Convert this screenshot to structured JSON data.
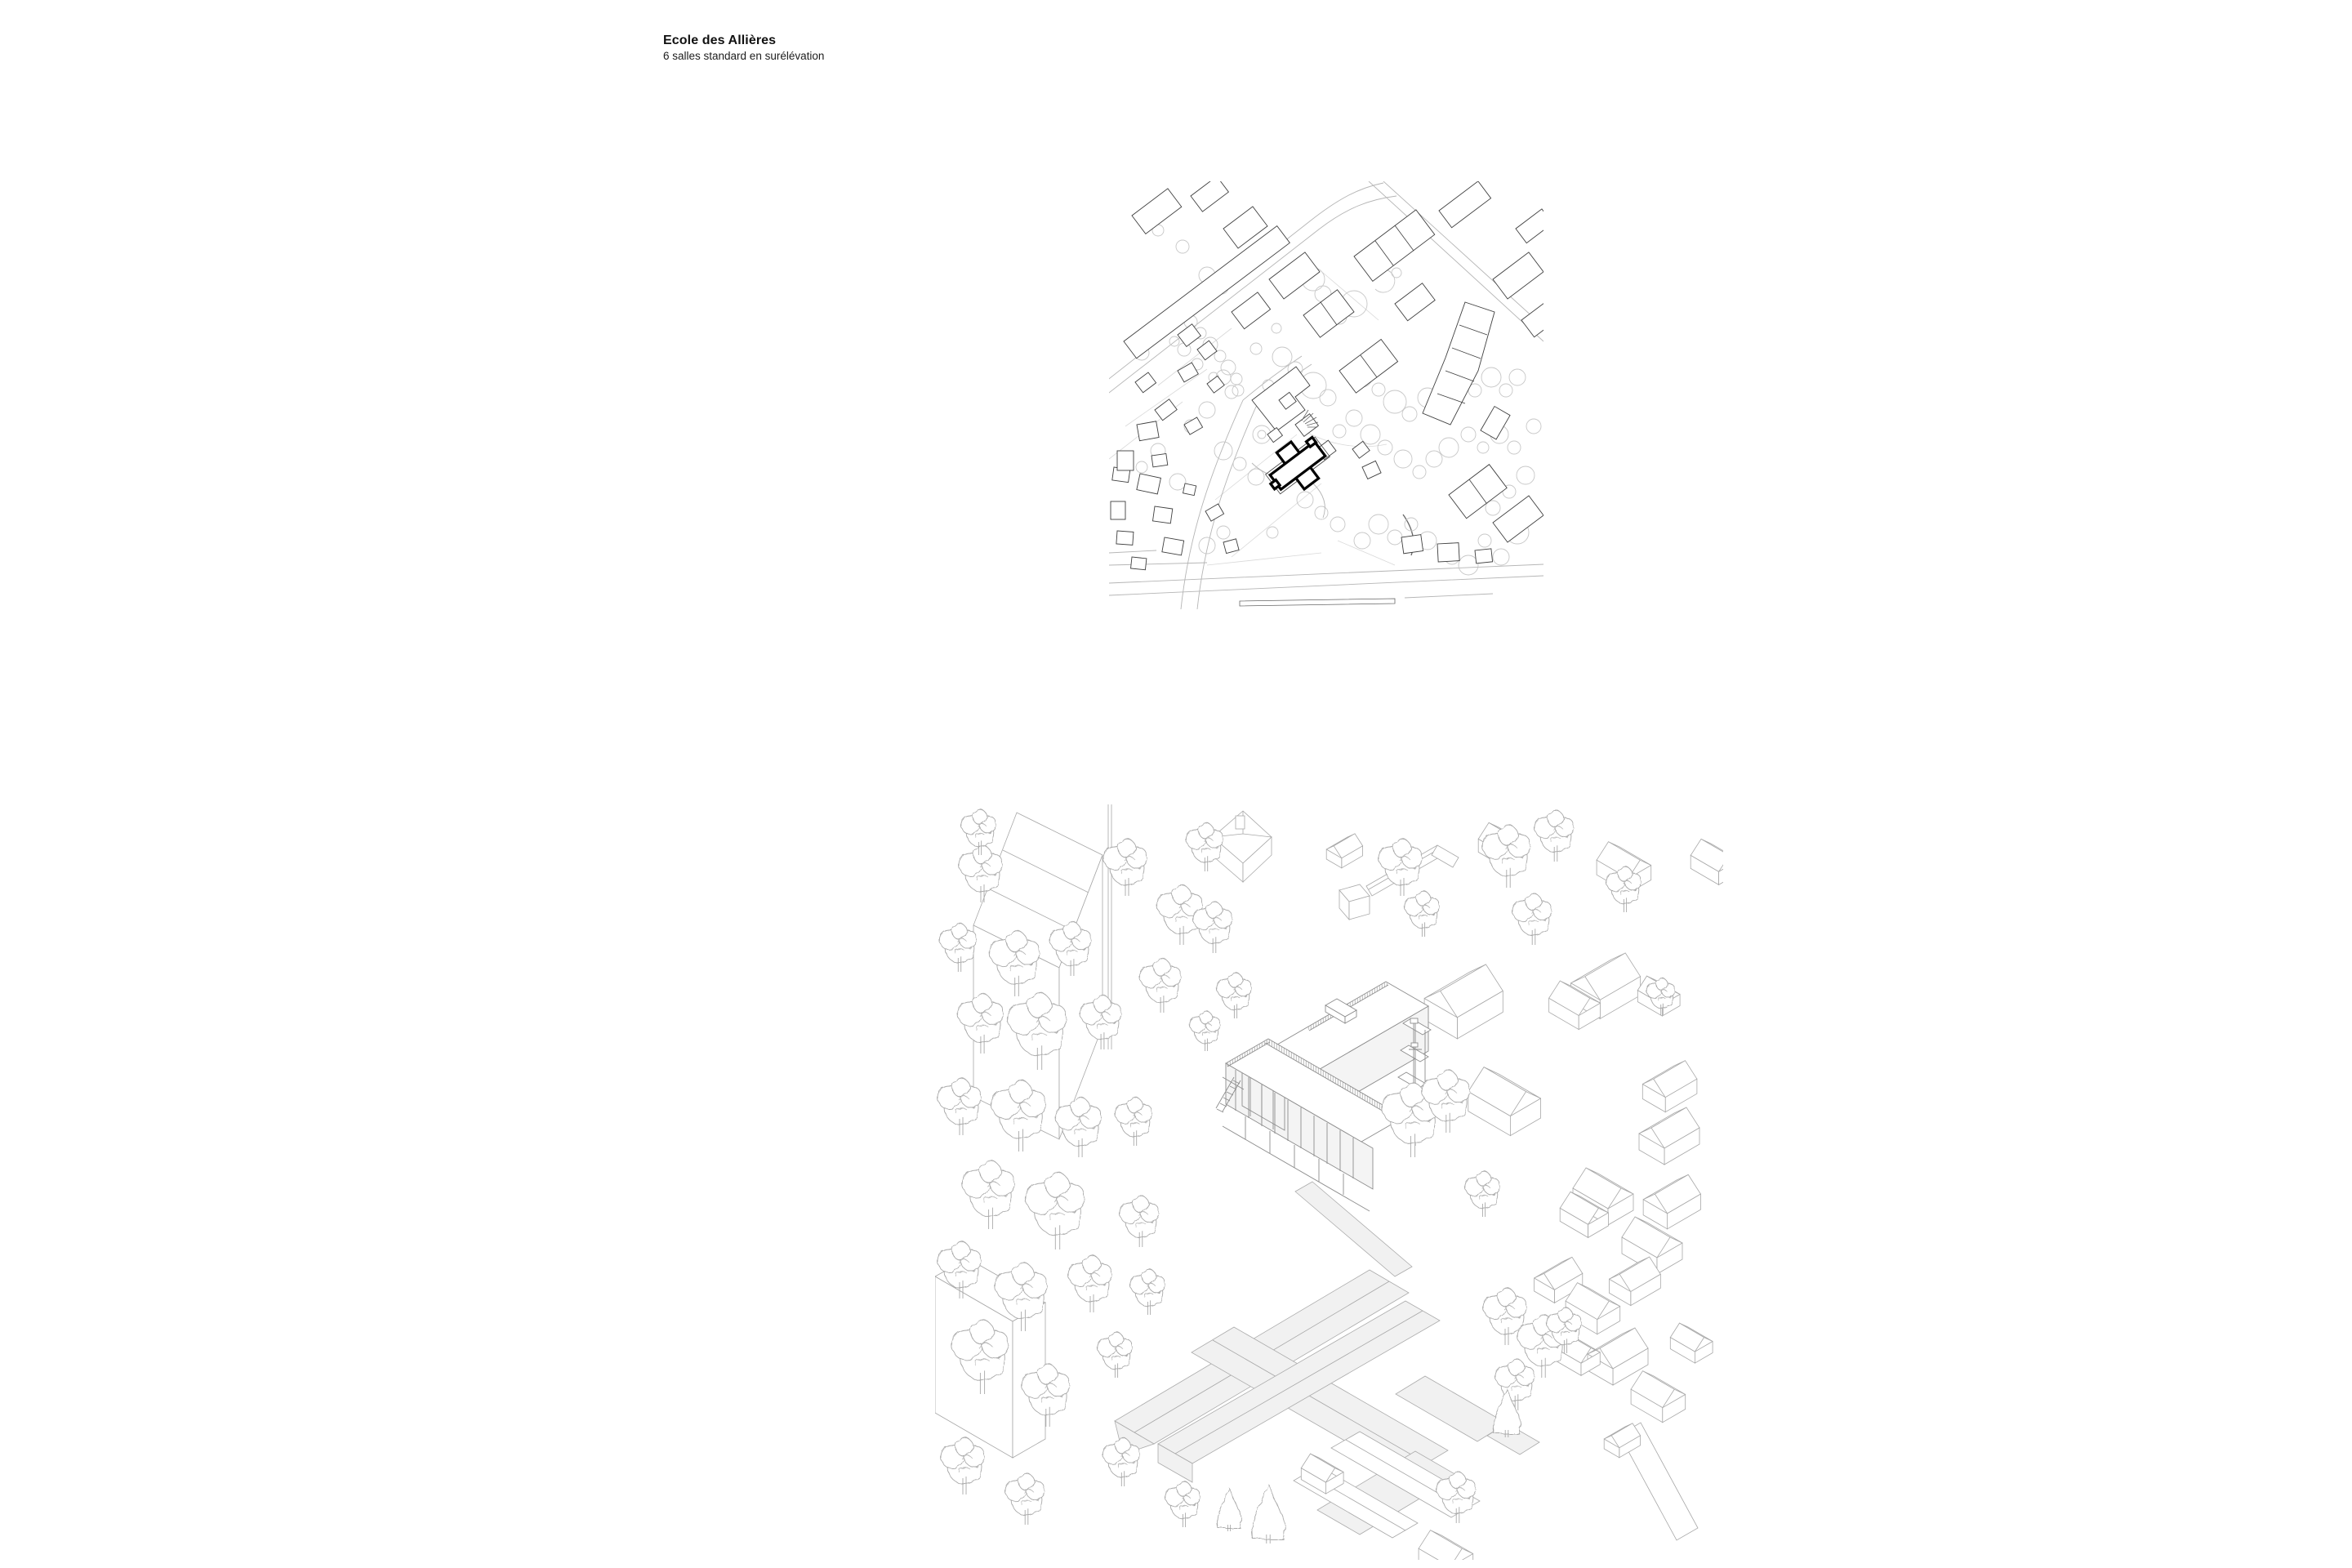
{
  "page": {
    "title": "Ecole des Allières",
    "subtitle": "6 salles standard en surélévation"
  },
  "figures": {
    "site_plan_label": "site-plan",
    "axonometric_label": "axonometric-view"
  },
  "colors": {
    "background": "#ffffff",
    "title_ink": "#111111",
    "plan_building_line": "#3f3f3f",
    "plan_highlight": "#000000",
    "plan_tree_line": "#c7c7c7",
    "plan_road_line": "#b5b5b5",
    "axo_line": "#a8a8a8",
    "axo_school_line": "#8d8d8d",
    "axo_roof_fill": "#f1f1f1"
  }
}
